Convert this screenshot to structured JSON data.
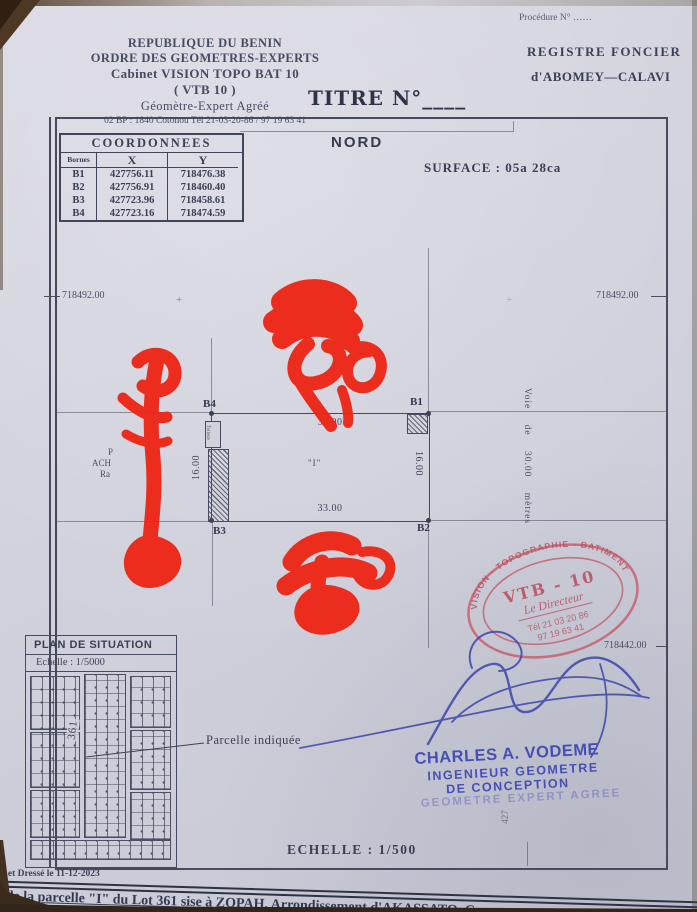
{
  "header": {
    "org": {
      "line1": "REPUBLIQUE DU BENIN",
      "line2": "ORDRE DES GEOMETRES-EXPERTS",
      "line3": "Cabinet VISION TOPO  BAT 10",
      "line4": "( VTB 10 )",
      "line5": "Géomètre-Expert Agréé",
      "line6": "02 BP : 1840 Cotonou  Tél 21-03-20-86 / 97 19 63 41"
    },
    "title": "TITRE N°____",
    "procedure": "Procédure  N° ……",
    "registre1": "REGISTRE  FONCIER",
    "registre2": "d'ABOMEY—CALAVI"
  },
  "map": {
    "north": "NORD",
    "surface": "SURFACE  :  05a  28ca",
    "coord_table": {
      "title": "COORDONNEES",
      "col_bornes": "Bornes",
      "col_x": "X",
      "col_y": "Y",
      "rows": [
        {
          "b": "B1",
          "x": "427756.11",
          "y": "718476.38"
        },
        {
          "b": "B2",
          "x": "427756.91",
          "y": "718460.40"
        },
        {
          "b": "B3",
          "x": "427723.96",
          "y": "718458.61"
        },
        {
          "b": "B4",
          "x": "427723.16",
          "y": "718474.59"
        }
      ]
    },
    "grid": {
      "left_northing": "718492.00",
      "right_northing": "718492.00",
      "lower_right_northing": "718442.00",
      "easting_partial": "427",
      "cross_mark": "+"
    },
    "parcel": {
      "b1": "B1",
      "b2": "B2",
      "b3": "B3",
      "b4": "B4",
      "top": "33.00",
      "bottom": "33.00",
      "left": "16.00",
      "right": "16.00",
      "center": "\"I\"",
      "toilette": "Toilette",
      "neighbor1": "P",
      "neighbor2": "ACH",
      "neighbor3": "Ra"
    },
    "road": "Voie de 30.00 mètres"
  },
  "stamp": {
    "arc": "VISION · TOPOGRAPHIE · BATIMENT",
    "name": "VTB - 10",
    "director": "Le Directeur",
    "tel1": "Tél  21 03 20 86",
    "tel2": "97 19 63 41",
    "color": "#c45a66"
  },
  "signature_block": {
    "name": "CHARLES A. VODEME",
    "role1": "INGENIEUR GEOMETRE",
    "role2": "DE CONCEPTION",
    "role3": "GEOMETRE EXPERT AGREE",
    "ink_color": "#3f49ac"
  },
  "situation": {
    "title": "PLAN  DE  SITUATION",
    "scale": "Echelle : 1/5000",
    "lot": "361",
    "callout": "Parcelle  indiquée"
  },
  "footer": {
    "scale": "ECHELLE  :  1/500",
    "drawn": "Levé et Dressé  le  11-12-2023",
    "parcel_line_a": "de la parcelle \"I\" du Lot 361 sise à ZOPAH,",
    "parcel_line_b": " Arrondissement d'AKASSATO, Co"
  },
  "annotation_colors": {
    "red_marker": "#ee2413",
    "blue_pen": "#3c46aa"
  }
}
